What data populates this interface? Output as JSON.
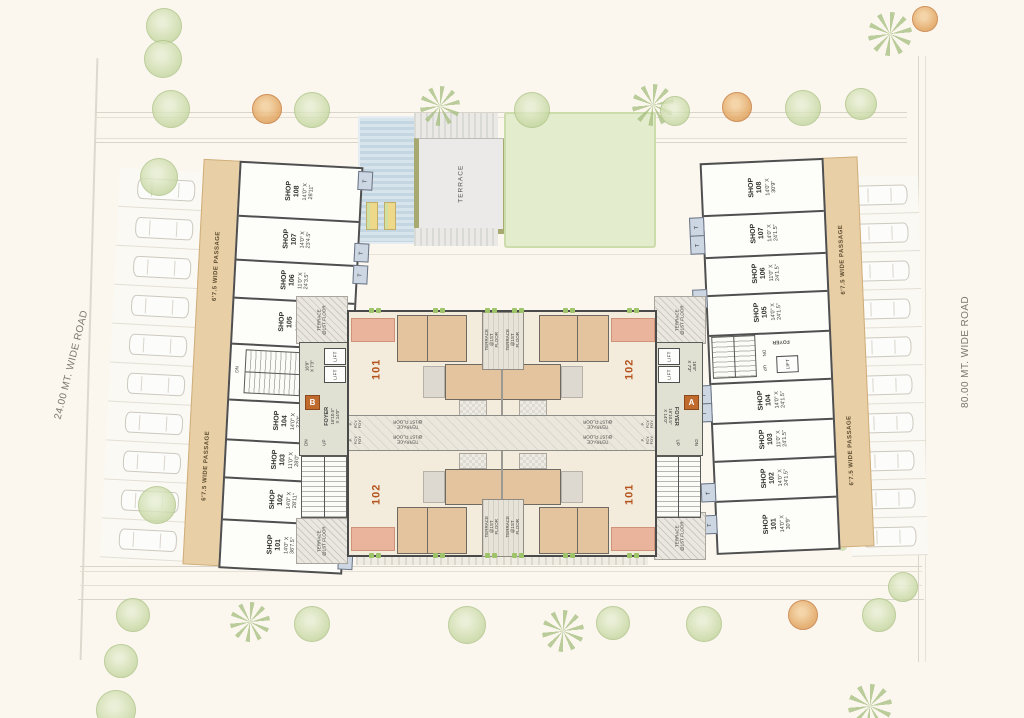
{
  "roads": {
    "left_label": "24.00 MT. WIDE ROAD",
    "right_label": "80.00 MT. WIDE ROAD"
  },
  "amenity": {
    "terrace_label": "TERRACE"
  },
  "common": {
    "toilet": "T",
    "lift": "LIFT",
    "dn": "DN",
    "up": "UP"
  },
  "left_wing": {
    "passage": "6'7.5 WIDE PASSAGE",
    "shops": [
      {
        "title": "SHOP\n108",
        "dims": "14'0\" X\n28'11\""
      },
      {
        "title": "SHOP\n107",
        "dims": "14'0\" X\n23'4.5\""
      },
      {
        "title": "SHOP\n106",
        "dims": "11'0\" X\n24'3.5\""
      },
      {
        "title": "SHOP\n105",
        "dims": "14'0\" X\n25'3\""
      },
      {
        "title": "SHOP\n104",
        "dims": "14'0\" X\n27'0\""
      },
      {
        "title": "SHOP\n103",
        "dims": "11'0\" X\n28'0\""
      },
      {
        "title": "SHOP\n102",
        "dims": "14'0\" X\n28'11\""
      },
      {
        "title": "SHOP\n101",
        "dims": "14'0\" X\n36'7.5\""
      }
    ]
  },
  "right_wing": {
    "passage": "6'7.5 WIDE PASSAGE",
    "foyer": "FOYER",
    "shops": [
      {
        "title": "SHOP\n108",
        "dims": "14'0\" X\n30'9\""
      },
      {
        "title": "SHOP\n107",
        "dims": "14'0\" X\n24'1.5\""
      },
      {
        "title": "SHOP\n106",
        "dims": "11'0\" X\n24'1.5\""
      },
      {
        "title": "SHOP\n105",
        "dims": "14'0\" X\n24'1.5\""
      },
      {
        "title": "SHOP\n104",
        "dims": "14'0\" X\n24'1.5\""
      },
      {
        "title": "SHOP\n103",
        "dims": "11'0\" X\n24'1.5\""
      },
      {
        "title": "SHOP\n102",
        "dims": "14'0\" X\n24'1.5\""
      },
      {
        "title": "SHOP\n101",
        "dims": "14'0\" X\n30'9\""
      }
    ]
  },
  "central": {
    "units": {
      "tl": "101",
      "tr": "102",
      "bl": "102",
      "br": "101"
    },
    "terrace_floor": "TERRACE\n@1ST FLOOR",
    "entry": "P. FCY. FOY.",
    "foyer_b": {
      "letter": "B",
      "name": "FOYER",
      "dims": "16'10.5\"\nX 14'0\""
    },
    "foyer_a": {
      "letter": "A",
      "name": "FOYER",
      "dims": "16'10.5\"\nX 14'0\""
    },
    "lift_dims": "16'9\"\nX 7'3\""
  },
  "colors": {
    "background_cream": "#fbf7ef",
    "wall_grey": "#4f4f4f",
    "passage_tan": "#e9cfa5",
    "room_tan": "#e3c49e",
    "salmon": "#e9b39c",
    "unit_label_orange": "#b4531d",
    "marker_orange": "#c06a2e",
    "toilet_blue": "#cdd6e3",
    "lawn_green": "#e3edcd",
    "pool_blue": "#c3d6e2"
  }
}
